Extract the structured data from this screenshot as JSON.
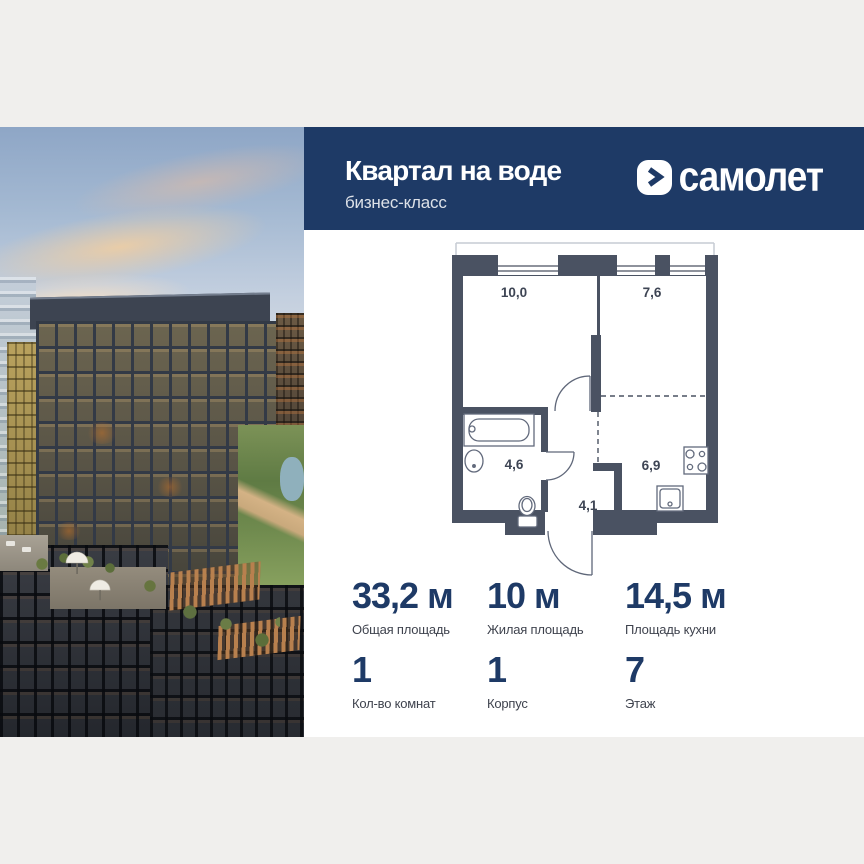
{
  "colors": {
    "brand_navy": "#1e3a66",
    "page_bg": "#f0efed",
    "plan_wall": "#4a5262",
    "stat_number": "#1e3a66"
  },
  "header": {
    "title": "Квартал на воде",
    "subtitle": "бизнес-класс"
  },
  "brand": {
    "name": "самолет",
    "logo_icon": "chevron-right"
  },
  "floor_plan": {
    "rooms": [
      {
        "id": "living-room",
        "area": "10,0"
      },
      {
        "id": "bedroom",
        "area": "7,6"
      },
      {
        "id": "bathroom",
        "area": "4,6"
      },
      {
        "id": "hallway",
        "area": "4,1"
      },
      {
        "id": "kitchen",
        "area": "6,9"
      }
    ]
  },
  "stats": {
    "items": [
      {
        "value": "33,2 м",
        "label": "Общая площадь"
      },
      {
        "value": "10 м",
        "label": "Жилая площадь"
      },
      {
        "value": "14,5 м",
        "label": "Площадь кухни"
      },
      {
        "value": "1",
        "label": "Кол-во комнат"
      },
      {
        "value": "1",
        "label": "Корпус"
      },
      {
        "value": "7",
        "label": "Этаж"
      }
    ]
  }
}
